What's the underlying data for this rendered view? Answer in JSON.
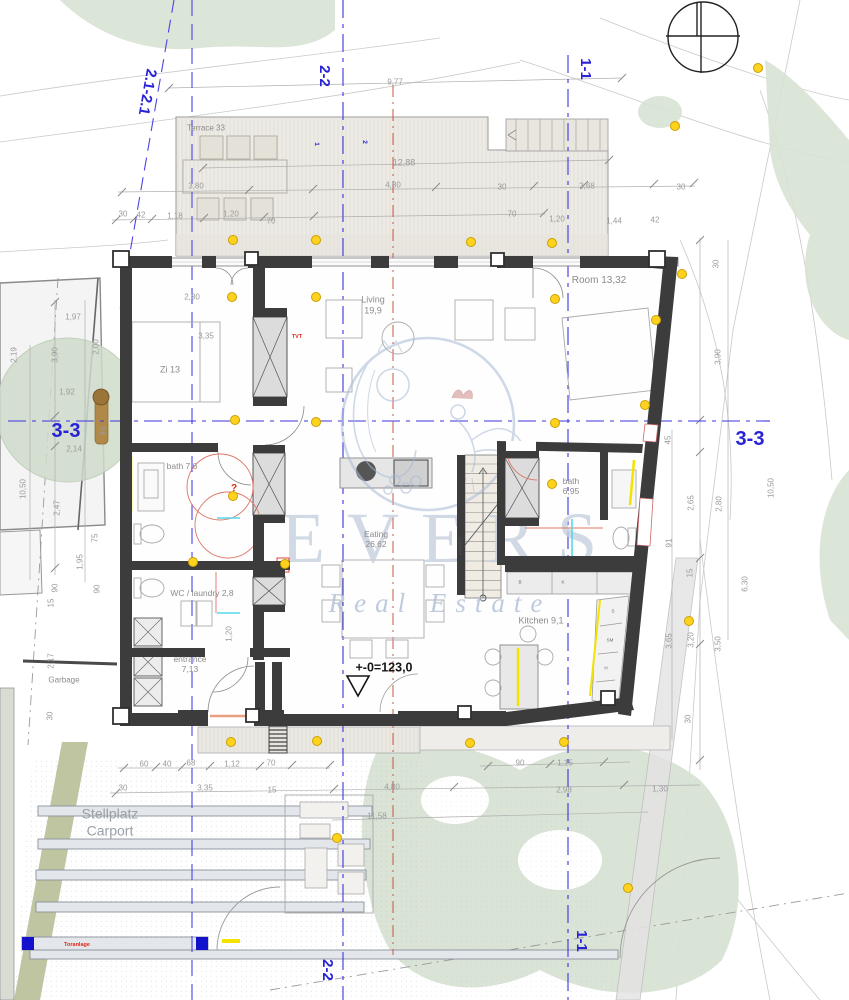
{
  "watermark": {
    "title": "EVERS",
    "subtitle": "Real Estate"
  },
  "rooms": [
    {
      "t": "Terrace 33",
      "x": 206,
      "y": 128,
      "size": 8
    },
    {
      "t": "Zi 13",
      "x": 170,
      "y": 370
    },
    {
      "lines": [
        "Living",
        "19,9"
      ],
      "x": 373,
      "y": 305
    },
    {
      "t": "Room 13,32",
      "x": 599,
      "y": 281,
      "size": 10
    },
    {
      "t": "bath 7,6",
      "x": 182,
      "y": 466,
      "size": 8.5
    },
    {
      "t": "WC / laundry 2,8",
      "x": 202,
      "y": 593,
      "size": 8.5
    },
    {
      "lines": [
        "entrance",
        "7,13"
      ],
      "x": 190,
      "y": 664,
      "size": 8.5
    },
    {
      "lines": [
        "Eating",
        "26,62"
      ],
      "x": 376,
      "y": 539,
      "size": 8.5
    },
    {
      "lines": [
        "bath",
        "6,95"
      ],
      "x": 571,
      "y": 486,
      "size": 8.5
    },
    {
      "t": "Kitchen 9,1",
      "x": 541,
      "y": 621
    },
    {
      "t": "Garbage",
      "x": 64,
      "y": 680,
      "size": 8
    },
    {
      "lines": [
        "Stellplatz",
        "Carport"
      ],
      "x": 110,
      "y": 822,
      "cls": "biggray"
    }
  ],
  "sections": [
    {
      "t": "2.1-2.1",
      "x": 147,
      "y": 92,
      "rot": 100
    },
    {
      "t": "2-2",
      "x": 324,
      "y": 76,
      "rot": 90
    },
    {
      "t": "1-1",
      "x": 585,
      "y": 69,
      "rot": 90
    },
    {
      "t": "3-3",
      "x": 66,
      "y": 432,
      "cls": "section big"
    },
    {
      "t": "3-3",
      "x": 750,
      "y": 440,
      "cls": "section big"
    },
    {
      "t": "2-2",
      "x": 327,
      "y": 970,
      "rot": 90
    },
    {
      "t": "1-1",
      "x": 581,
      "y": 941,
      "rot": 90
    },
    {
      "t": "1",
      "x": 316,
      "y": 144,
      "rot": 90,
      "cls": "section tiny"
    },
    {
      "t": "2",
      "x": 364,
      "y": 142,
      "rot": 90,
      "cls": "section tiny"
    }
  ],
  "dimensions": [
    {
      "t": "9,77",
      "x": 395,
      "y": 82
    },
    {
      "t": "12,88",
      "x": 404,
      "y": 163,
      "size": 9
    },
    {
      "t": "3,80",
      "x": 196,
      "y": 186
    },
    {
      "t": "4,80",
      "x": 393,
      "y": 185
    },
    {
      "t": "30",
      "x": 502,
      "y": 187
    },
    {
      "t": "3,68",
      "x": 587,
      "y": 186
    },
    {
      "t": "30",
      "x": 681,
      "y": 187
    },
    {
      "t": "30",
      "x": 123,
      "y": 214
    },
    {
      "t": "42",
      "x": 141,
      "y": 215
    },
    {
      "t": "1,18",
      "x": 175,
      "y": 216
    },
    {
      "t": "1,20",
      "x": 231,
      "y": 214
    },
    {
      "t": "70",
      "x": 271,
      "y": 221
    },
    {
      "t": "70",
      "x": 512,
      "y": 214
    },
    {
      "t": "1,20",
      "x": 557,
      "y": 219
    },
    {
      "t": "1,44",
      "x": 614,
      "y": 221
    },
    {
      "t": "42",
      "x": 655,
      "y": 220
    },
    {
      "t": "30",
      "x": 716,
      "y": 264,
      "rot": -90
    },
    {
      "t": "1,97",
      "x": 73,
      "y": 317
    },
    {
      "t": "2,19",
      "x": 14,
      "y": 355,
      "rot": -90
    },
    {
      "t": "3,90",
      "x": 55,
      "y": 355,
      "rot": -90
    },
    {
      "t": "2,00",
      "x": 96,
      "y": 347,
      "rot": -90
    },
    {
      "t": "1,92",
      "x": 67,
      "y": 392
    },
    {
      "t": "2,14",
      "x": 74,
      "y": 449
    },
    {
      "t": "45",
      "x": 103,
      "y": 431,
      "rot": -90
    },
    {
      "t": "10,50",
      "x": 23,
      "y": 489,
      "rot": -90
    },
    {
      "t": "2,47",
      "x": 57,
      "y": 508,
      "rot": -90
    },
    {
      "t": "75",
      "x": 95,
      "y": 538,
      "rot": -90
    },
    {
      "t": "1,95",
      "x": 80,
      "y": 562,
      "rot": -90
    },
    {
      "t": "15",
      "x": 51,
      "y": 603,
      "rot": -90
    },
    {
      "t": "90",
      "x": 55,
      "y": 588,
      "rot": -90
    },
    {
      "t": "90",
      "x": 97,
      "y": 589,
      "rot": -90
    },
    {
      "t": "2,17",
      "x": 51,
      "y": 661,
      "rot": -90
    },
    {
      "t": "30",
      "x": 50,
      "y": 716,
      "rot": -90
    },
    {
      "t": "2,80",
      "x": 192,
      "y": 297
    },
    {
      "t": "3,35",
      "x": 206,
      "y": 336
    },
    {
      "t": "1,20",
      "x": 229,
      "y": 634,
      "rot": -90
    },
    {
      "t": "3,90",
      "x": 718,
      "y": 357,
      "rot": -90
    },
    {
      "t": "45",
      "x": 668,
      "y": 440,
      "rot": -90
    },
    {
      "t": "10,50",
      "x": 771,
      "y": 488,
      "rot": -90
    },
    {
      "t": "2,65",
      "x": 691,
      "y": 503,
      "rot": -90
    },
    {
      "t": "2,80",
      "x": 719,
      "y": 504,
      "rot": -90
    },
    {
      "t": "91",
      "x": 669,
      "y": 543,
      "rot": -90
    },
    {
      "t": "15",
      "x": 690,
      "y": 573,
      "rot": -90
    },
    {
      "t": "6,30",
      "x": 745,
      "y": 584,
      "rot": -90
    },
    {
      "t": "3,65",
      "x": 669,
      "y": 641,
      "rot": -90
    },
    {
      "t": "3,20",
      "x": 691,
      "y": 640,
      "rot": -90
    },
    {
      "t": "3,50",
      "x": 718,
      "y": 644,
      "rot": -90
    },
    {
      "t": "30",
      "x": 688,
      "y": 719,
      "rot": -90
    },
    {
      "t": "60",
      "x": 144,
      "y": 764
    },
    {
      "t": "40",
      "x": 167,
      "y": 764
    },
    {
      "t": "68",
      "x": 191,
      "y": 763
    },
    {
      "t": "1,12",
      "x": 232,
      "y": 764
    },
    {
      "t": "70",
      "x": 271,
      "y": 763
    },
    {
      "t": "30",
      "x": 123,
      "y": 788
    },
    {
      "t": "3,35",
      "x": 205,
      "y": 788
    },
    {
      "t": "15",
      "x": 272,
      "y": 790
    },
    {
      "t": "4,80",
      "x": 392,
      "y": 787
    },
    {
      "t": "11,58",
      "x": 377,
      "y": 816
    },
    {
      "t": "90",
      "x": 520,
      "y": 763
    },
    {
      "t": "1,15",
      "x": 565,
      "y": 763
    },
    {
      "t": "2,98",
      "x": 564,
      "y": 790
    },
    {
      "t": "1,30",
      "x": 660,
      "y": 789
    }
  ],
  "annotations": [
    {
      "t": "+-0=123,0",
      "x": 384,
      "y": 668,
      "cls": "elev"
    },
    {
      "t": "TVT",
      "x": 297,
      "y": 337,
      "cls": "red"
    },
    {
      "t": "?",
      "x": 234,
      "y": 489,
      "cls": "red",
      "size": 10
    },
    {
      "t": "Toranlage",
      "x": 77,
      "y": 945,
      "cls": "red"
    },
    {
      "t": "14x18/27",
      "x": 460,
      "y": 546,
      "cls": "stairnote",
      "rot": -90
    }
  ],
  "kitchen_letters": [
    {
      "t": "B",
      "x": 520,
      "y": 582
    },
    {
      "t": "K",
      "x": 563,
      "y": 582
    },
    {
      "t": "S",
      "x": 613,
      "y": 611
    },
    {
      "t": "SM",
      "x": 610,
      "y": 640
    },
    {
      "t": "H",
      "x": 606,
      "y": 668
    }
  ],
  "colors": {
    "section_line": "#3a34e0",
    "red_line": "#cc5544",
    "wall": "#3c3c3c",
    "light_dot": "#ffd21e",
    "vegetation": "#d7e2d4",
    "olive": "#b8bf97",
    "watermark": "#aebfd6",
    "accent_yellow": "#f2e400",
    "annotation_red": "#e02818"
  }
}
